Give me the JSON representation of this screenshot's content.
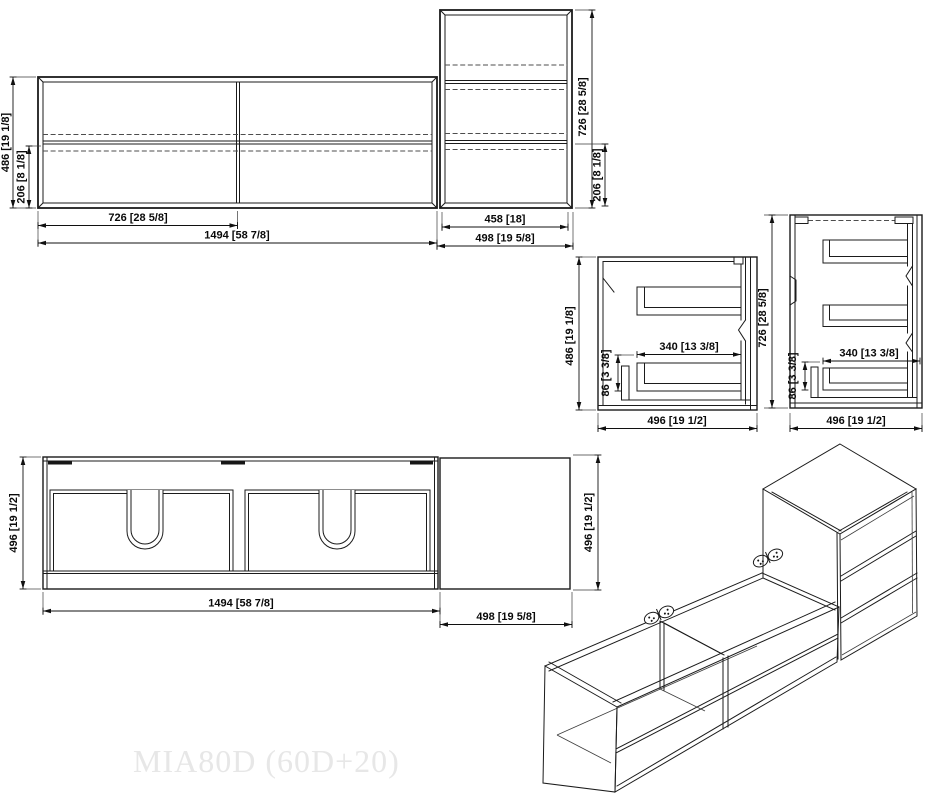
{
  "title": "MIA80D (60D+20)",
  "views": {
    "front_wide": {
      "height": "486 [19 1/8]",
      "drawer_height": "206 [8 1/8]",
      "half_width": "726 [28 5/8]",
      "width": "1494 [58 7/8]"
    },
    "front_tall": {
      "height": "726 [28 5/8]",
      "drawer_height": "206 [8 1/8]",
      "inner_width": "458 [18]",
      "width": "498 [19 5/8]"
    },
    "section_two_drawer": {
      "height": "486 [19 1/8]",
      "drawer_width": "340 [13 3/8]",
      "drawer_depth": "86 [3 3/8]",
      "depth": "496 [19 1/2]"
    },
    "section_three_drawer": {
      "height": "726 [28 5/8]",
      "drawer_width": "340 [13 3/8]",
      "drawer_depth": "86 [3 3/8]",
      "depth": "496 [19 1/2]"
    },
    "plan": {
      "depth": "496 [19 1/2]",
      "width": "1494 [58 7/8]",
      "side_width": "498 [19 5/8]",
      "side_depth": "496 [19 1/2]"
    }
  },
  "colors": {
    "line": "#1b1b1b",
    "dimension_text": "#0a0a0a",
    "watermark": "#e7e7e7",
    "background": "#ffffff"
  }
}
